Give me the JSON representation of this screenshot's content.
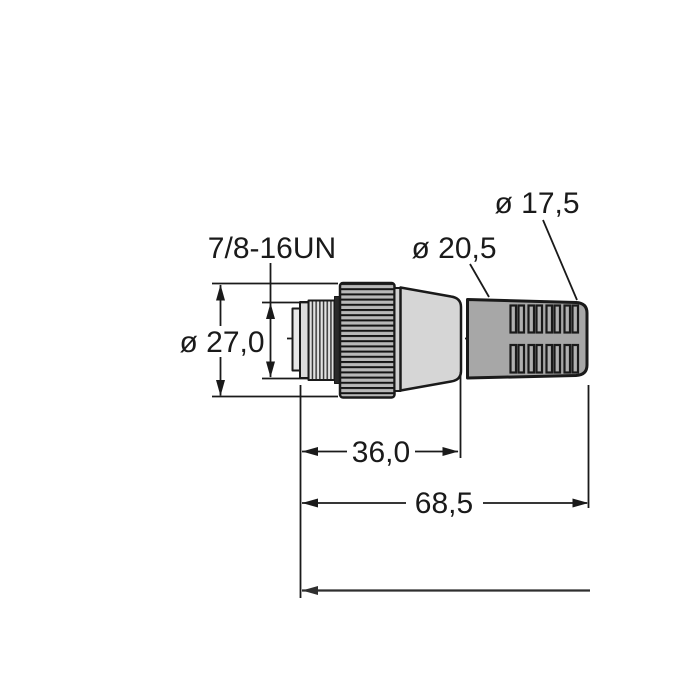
{
  "drawing": {
    "labels": {
      "thread_spec": "7/8-16UN",
      "nut_diameter": "ø 27,0",
      "boot_front_diameter": "ø 20,5",
      "boot_rear_diameter": "ø 17,5",
      "body_length": "36,0",
      "overall_length": "68,5"
    },
    "colors": {
      "outline": "#1a1a1a",
      "connector_body": "#d6d6d6",
      "connector_rim": "#d0d0d0",
      "cable_boot": "#a7a7a7",
      "boot_slot": "#b0b0b0",
      "knurl_base": "#b8b8b8",
      "knurl_rib": "#141414",
      "thread_face": "#e2e2e2",
      "thread_line": "#3a3a3a",
      "front_step": "#e8e8e8",
      "front_collar": "#dcdcdc",
      "shoulder": "#2a2a2a",
      "background": "#ffffff"
    }
  }
}
